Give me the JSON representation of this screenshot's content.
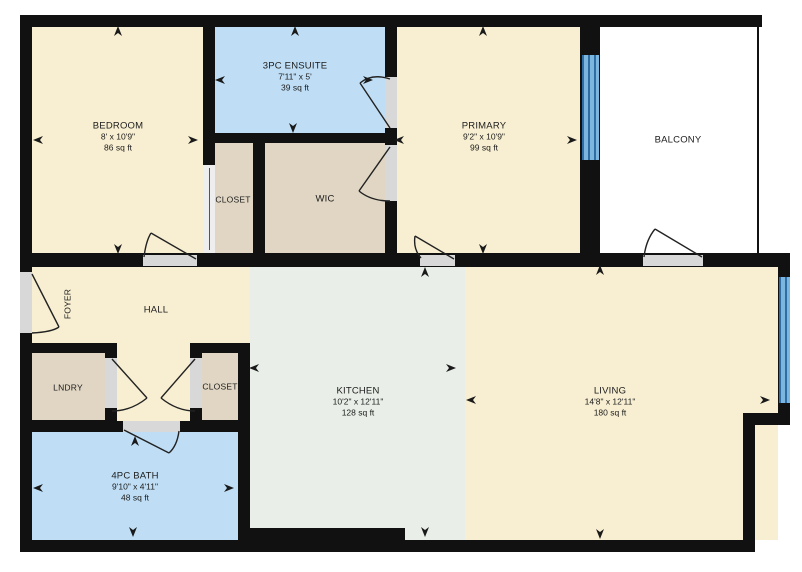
{
  "plan": {
    "rooms": {
      "bedroom": {
        "name": "BEDROOM",
        "dims": "8' x 10'9\"",
        "area": "86 sq ft"
      },
      "ensuite": {
        "name": "3PC ENSUITE",
        "dims": "7'11\" x 5'",
        "area": "39 sq ft"
      },
      "primary": {
        "name": "PRIMARY",
        "dims": "9'2\" x 10'9\"",
        "area": "99 sq ft"
      },
      "balcony": {
        "name": "BALCONY"
      },
      "closet_upper": {
        "name": "CLOSET"
      },
      "wic": {
        "name": "WIC"
      },
      "foyer": {
        "name": "FOYER"
      },
      "hall": {
        "name": "HALL"
      },
      "lndry": {
        "name": "LNDRY"
      },
      "closet_lower": {
        "name": "CLOSET"
      },
      "kitchen": {
        "name": "KITCHEN",
        "dims": "10'2\" x 12'11\"",
        "area": "128 sq ft"
      },
      "living": {
        "name": "LIVING",
        "dims": "14'8\" x 12'11\"",
        "area": "180 sq ft"
      },
      "bath": {
        "name": "4PC BATH",
        "dims": "9'10\" x 4'11\"",
        "area": "48 sq ft"
      }
    },
    "colors": {
      "wall": "#111111",
      "room_cream": "#f8efd2",
      "room_blue": "#bfdef5",
      "room_tan": "#e0d6c3",
      "room_kitchen": "#e9efe8",
      "balcony_white": "#ffffff",
      "window_blue": "#7cb5dd",
      "threshold_gray": "#d8d8d8"
    },
    "icons": {
      "dimension-arrow": "solid triangular arrowhead pointing at wall",
      "door-swing-icon": "quarter-circle door swing arc"
    }
  }
}
